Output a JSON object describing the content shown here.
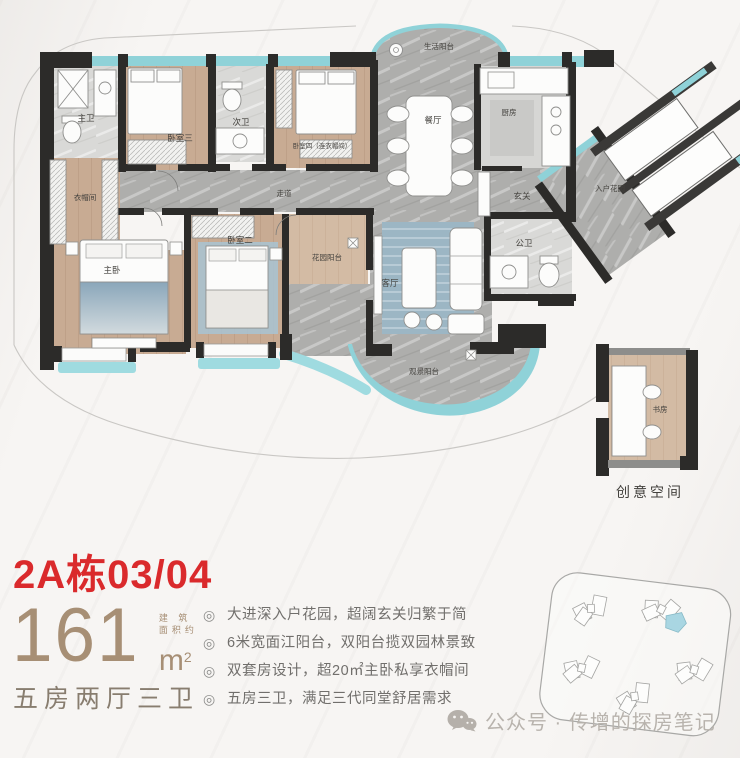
{
  "colors": {
    "accent_red": "#da2a2c",
    "beige": "#a78f75",
    "teal_glass": "#8fd2d8",
    "wall_dark": "#2c2b29",
    "wood": "#c8ab93",
    "marble": "#aeaeac"
  },
  "plan": {
    "rooms": {
      "service_balcony": "生活阳台",
      "master_bath": "主卫",
      "bedroom3": "卧室三",
      "second_bath": "次卫",
      "bedroom4": "卧室四（连衣帽间）",
      "kitchen": "厨房",
      "dining": "餐厅",
      "foyer": "玄关",
      "entry_garden": "入户花园",
      "cloakroom": "衣帽间",
      "corridor": "走道",
      "master_bedroom": "主卧",
      "bedroom2": "卧室二",
      "garden_balcony": "花园阳台",
      "living": "客厅",
      "public_bath": "公卫",
      "view_balcony": "观景阳台",
      "study": "书房",
      "creative_space": "创意空间"
    }
  },
  "info": {
    "unit_title": "2A栋03/04",
    "area_value": "161",
    "area_note_line1": "建 筑",
    "area_note_line2": "面积约",
    "area_unit": "m",
    "area_unit_sup": "2",
    "layout_text": "五房两厅三卫"
  },
  "features": {
    "bullet_icon": "◎",
    "items": [
      {
        "text": "大进深入户花园，超阔玄关归繁于简"
      },
      {
        "text": "6米宽面江阳台，双阳台揽双园林景致"
      },
      {
        "text": "双套房设计，超20㎡主卧私享衣帽间"
      },
      {
        "text": "五房三卫，满足三代同堂舒居需求"
      }
    ]
  },
  "watermark": {
    "text": "公众号 · 传增的探房笔记"
  }
}
